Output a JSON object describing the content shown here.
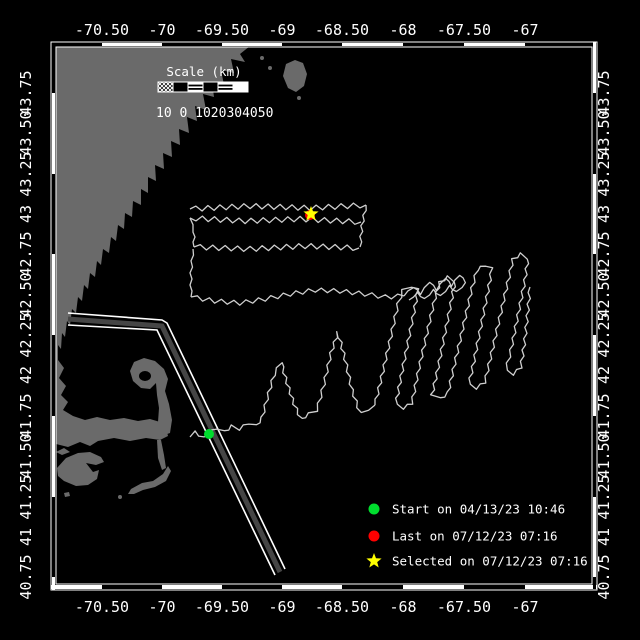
{
  "colors": {
    "background": "#000000",
    "frame": "#ffffff",
    "text": "#ffffff",
    "land": "#6a6a6a",
    "track": "#cfcfcf",
    "lane_center": "#454545",
    "lane_edge": "#ffffff",
    "green": "#00dd2e",
    "red": "#ff0000",
    "yellow": "#ffff00"
  },
  "map_frame": {
    "outer": [
      51,
      42,
      597,
      590
    ],
    "inner": [
      56,
      47,
      592,
      584
    ],
    "x_ticks": [
      51,
      102,
      162,
      222,
      282,
      342,
      403,
      464,
      525,
      597
    ],
    "y_ticks": [
      42,
      93,
      174,
      254,
      335,
      416,
      497,
      577,
      590
    ]
  },
  "axes": {
    "x_labels": [
      "-70.50",
      "-70",
      "-69.50",
      "-69",
      "-68.50",
      "-68",
      "-67.50",
      "-67"
    ],
    "x_positions": [
      102,
      162,
      222,
      282,
      342,
      403,
      464,
      525
    ],
    "top_baseline_y": 35,
    "bottom_baseline_y": 612,
    "y_labels": [
      "40.75",
      "41",
      "41.25",
      "41.50",
      "41.75",
      "42",
      "42.25",
      "42.50",
      "42.75",
      "43",
      "43.25",
      "43.50",
      "43.75"
    ],
    "y_positions": [
      577,
      537,
      497,
      456,
      416,
      375,
      335,
      295,
      254,
      214,
      174,
      133,
      93
    ],
    "left_center_x": 31,
    "right_center_x": 609
  },
  "scale_bar": {
    "title": "Scale (km)",
    "title_x": 204,
    "title_y": 76,
    "bar_x": 158,
    "bar_y": 82,
    "cell_w": 15,
    "cell_h": 10,
    "cells": [
      "hatch",
      "black",
      "striped",
      "black",
      "striped",
      "white"
    ],
    "labels_text": "10 0 1020304050",
    "labels_x": 156,
    "labels_y": 117
  },
  "legend": {
    "marker_x": 374,
    "text_x": 392,
    "rows_y": [
      509,
      536,
      561
    ],
    "items": [
      {
        "marker": "green-dot",
        "label": "Start on 04/13/23 10:46"
      },
      {
        "marker": "red-dot",
        "label": "Last on 07/12/23 07:16"
      },
      {
        "marker": "yellow-star",
        "label": "Selected on 07/12/23 07:16"
      }
    ]
  },
  "markers": {
    "start": {
      "x": 209,
      "y": 434,
      "type": "circle",
      "r": 5,
      "color": "#00dd2e"
    },
    "last": {
      "x": 310,
      "y": 215,
      "type": "circle",
      "r": 5,
      "color": "#ff0000"
    },
    "selected": {
      "x": 311,
      "y": 214,
      "type": "star",
      "r": 8,
      "color": "#ffff00"
    }
  },
  "land": {
    "polygons": [
      [
        [
          56,
          46
        ],
        [
          250,
          46
        ],
        [
          240,
          54
        ],
        [
          245,
          62
        ],
        [
          231,
          59
        ],
        [
          234,
          73
        ],
        [
          221,
          70
        ],
        [
          224,
          85
        ],
        [
          212,
          82
        ],
        [
          214,
          97
        ],
        [
          203,
          94
        ],
        [
          206,
          110
        ],
        [
          195,
          106
        ],
        [
          197,
          121
        ],
        [
          187,
          117
        ],
        [
          189,
          133
        ],
        [
          179,
          129
        ],
        [
          180,
          145
        ],
        [
          171,
          141
        ],
        [
          172,
          157
        ],
        [
          163,
          153
        ],
        [
          164,
          169
        ],
        [
          155,
          165
        ],
        [
          156,
          181
        ],
        [
          148,
          177
        ],
        [
          148,
          193
        ],
        [
          141,
          189
        ],
        [
          141,
          205
        ],
        [
          133,
          201
        ],
        [
          132,
          217
        ],
        [
          125,
          213
        ],
        [
          124,
          229
        ],
        [
          118,
          225
        ],
        [
          116,
          241
        ],
        [
          111,
          237
        ],
        [
          109,
          253
        ],
        [
          103,
          249
        ],
        [
          101,
          265
        ],
        [
          97,
          261
        ],
        [
          95,
          277
        ],
        [
          90,
          273
        ],
        [
          88,
          289
        ],
        [
          84,
          285
        ],
        [
          82,
          301
        ],
        [
          78,
          297
        ],
        [
          76,
          313
        ],
        [
          72,
          309
        ],
        [
          70,
          325
        ],
        [
          67,
          321
        ],
        [
          65,
          337
        ],
        [
          62,
          333
        ],
        [
          61,
          349
        ],
        [
          58,
          345
        ],
        [
          58,
          360
        ],
        [
          64,
          368
        ],
        [
          59,
          378
        ],
        [
          66,
          386
        ],
        [
          61,
          395
        ],
        [
          68,
          402
        ],
        [
          63,
          410
        ],
        [
          73,
          416
        ],
        [
          85,
          420
        ],
        [
          97,
          417
        ],
        [
          110,
          420
        ],
        [
          124,
          418
        ],
        [
          138,
          421
        ],
        [
          150,
          419
        ],
        [
          160,
          422
        ],
        [
          166,
          428
        ],
        [
          168,
          436
        ],
        [
          160,
          440
        ],
        [
          146,
          438
        ],
        [
          130,
          441
        ],
        [
          114,
          438
        ],
        [
          98,
          441
        ],
        [
          90,
          446
        ],
        [
          80,
          442
        ],
        [
          68,
          447
        ],
        [
          56,
          444
        ]
      ],
      [
        [
          156,
          438
        ],
        [
          170,
          433
        ],
        [
          172,
          420
        ],
        [
          169,
          404
        ],
        [
          165,
          391
        ],
        [
          168,
          379
        ],
        [
          164,
          369
        ],
        [
          155,
          361
        ],
        [
          144,
          358
        ],
        [
          134,
          362
        ],
        [
          130,
          371
        ],
        [
          133,
          381
        ],
        [
          141,
          388
        ],
        [
          150,
          389
        ],
        [
          156,
          383
        ],
        [
          157,
          395
        ],
        [
          159,
          408
        ],
        [
          158,
          422
        ]
      ],
      [
        [
          157,
          440
        ],
        [
          161,
          440
        ],
        [
          164,
          455
        ],
        [
          166,
          468
        ],
        [
          162,
          470
        ],
        [
          158,
          458
        ]
      ],
      [
        [
          131,
          489
        ],
        [
          142,
          483
        ],
        [
          153,
          481
        ],
        [
          163,
          474
        ],
        [
          168,
          466
        ],
        [
          171,
          471
        ],
        [
          166,
          481
        ],
        [
          155,
          487
        ],
        [
          143,
          490
        ],
        [
          134,
          494
        ],
        [
          128,
          494
        ]
      ],
      [
        [
          57,
          468
        ],
        [
          66,
          458
        ],
        [
          78,
          453
        ],
        [
          90,
          452
        ],
        [
          101,
          457
        ],
        [
          104,
          462
        ],
        [
          96,
          465
        ],
        [
          86,
          463
        ],
        [
          93,
          472
        ],
        [
          99,
          470
        ],
        [
          97,
          479
        ],
        [
          88,
          485
        ],
        [
          76,
          486
        ],
        [
          64,
          481
        ],
        [
          58,
          476
        ]
      ],
      [
        [
          56,
          452
        ],
        [
          64,
          448
        ],
        [
          70,
          452
        ],
        [
          62,
          455
        ]
      ],
      [
        [
          64,
          493
        ],
        [
          69,
          492
        ],
        [
          70,
          496
        ],
        [
          65,
          497
        ]
      ],
      [
        [
          286,
          64
        ],
        [
          295,
          60
        ],
        [
          303,
          63
        ],
        [
          307,
          74
        ],
        [
          304,
          86
        ],
        [
          296,
          92
        ],
        [
          288,
          88
        ],
        [
          283,
          76
        ]
      ]
    ],
    "harbor_cut": {
      "cx": 145,
      "cy": 376,
      "rx": 6,
      "ry": 5
    },
    "spots": [
      [
        262,
        58,
        2
      ],
      [
        270,
        68,
        2
      ],
      [
        299,
        98,
        2
      ],
      [
        220,
        58,
        2
      ],
      [
        206,
        76,
        2
      ],
      [
        186,
        90,
        2
      ],
      [
        168,
        112,
        2
      ],
      [
        150,
        130,
        2
      ],
      [
        120,
        497,
        2
      ]
    ]
  },
  "lane": {
    "edges": [
      [
        [
          68,
          313
        ],
        [
          162,
          320
        ],
        [
          167,
          323
        ],
        [
          285,
          569
        ]
      ],
      [
        [
          68,
          325
        ],
        [
          157,
          330
        ],
        [
          275,
          575
        ]
      ]
    ],
    "center": [
      [
        68,
        319
      ],
      [
        162,
        326
      ],
      [
        280,
        572
      ]
    ]
  },
  "track": {
    "paths": [
      {
        "pts": [
          [
            190,
            209
          ],
          [
            250,
            206
          ],
          [
            310,
            208
          ],
          [
            366,
            205
          ]
        ],
        "amp": 2.6
      },
      {
        "pts": [
          [
            366,
            205
          ],
          [
            362,
            226
          ],
          [
            360,
            247
          ]
        ],
        "amp": 1.2
      },
      {
        "pts": [
          [
            361,
            222
          ],
          [
            300,
            219
          ],
          [
            245,
            221
          ],
          [
            190,
            218
          ]
        ],
        "amp": 2.6
      },
      {
        "pts": [
          [
            190,
            218
          ],
          [
            194,
            232
          ],
          [
            194,
            247
          ]
        ],
        "amp": 1.0
      },
      {
        "pts": [
          [
            194,
            247
          ],
          [
            250,
            249
          ],
          [
            305,
            246
          ],
          [
            359,
            248
          ]
        ],
        "amp": 2.6
      },
      {
        "pts": [
          [
            193,
            249
          ],
          [
            191,
            273
          ],
          [
            191,
            297
          ]
        ],
        "amp": 1.0
      },
      {
        "pts": [
          [
            191,
            297
          ],
          [
            215,
            301
          ],
          [
            240,
            303
          ],
          [
            265,
            299
          ],
          [
            290,
            294
          ],
          [
            315,
            290
          ],
          [
            340,
            291
          ],
          [
            365,
            294
          ],
          [
            385,
            297
          ],
          [
            404,
            296
          ]
        ],
        "amp": 2.2
      },
      {
        "pts": [
          [
            404,
            296
          ],
          [
            413,
            287
          ],
          [
            421,
            294
          ],
          [
            429,
            282
          ],
          [
            437,
            290
          ],
          [
            445,
            278
          ],
          [
            452,
            286
          ],
          [
            459,
            275
          ],
          [
            466,
            282
          ],
          [
            457,
            292
          ],
          [
            449,
            286
          ],
          [
            441,
            296
          ],
          [
            433,
            290
          ],
          [
            425,
            299
          ],
          [
            417,
            293
          ],
          [
            409,
            300
          ]
        ],
        "amp": 0.8
      },
      {
        "pts": [
          [
            190,
            437
          ],
          [
            196,
            432
          ],
          [
            203,
            438
          ],
          [
            209,
            434
          ],
          [
            216,
            428
          ],
          [
            224,
            432
          ],
          [
            232,
            426
          ],
          [
            240,
            429
          ],
          [
            248,
            423
          ],
          [
            256,
            426
          ],
          [
            262,
            418
          ],
          [
            267,
            399
          ],
          [
            274,
            375
          ],
          [
            281,
            362
          ],
          [
            287,
            383
          ],
          [
            294,
            404
          ],
          [
            301,
            419
          ],
          [
            309,
            414
          ],
          [
            317,
            410
          ],
          [
            324,
            384
          ],
          [
            331,
            353
          ],
          [
            338,
            332
          ],
          [
            345,
            359
          ],
          [
            352,
            390
          ],
          [
            360,
            413
          ],
          [
            368,
            409
          ],
          [
            375,
            405
          ]
        ],
        "amp": 1.4
      },
      {
        "pts": [
          [
            375,
            405
          ],
          [
            383,
            371
          ],
          [
            391,
            336
          ],
          [
            398,
            304
          ],
          [
            403,
            290
          ],
          [
            411,
            286
          ],
          [
            418,
            290
          ],
          [
            414,
            312
          ],
          [
            407,
            347
          ],
          [
            400,
            382
          ],
          [
            396,
            404
          ],
          [
            404,
            408
          ],
          [
            412,
            403
          ],
          [
            419,
            368
          ],
          [
            427,
            333
          ],
          [
            435,
            298
          ],
          [
            440,
            282
          ],
          [
            448,
            277
          ],
          [
            455,
            281
          ],
          [
            451,
            303
          ],
          [
            444,
            338
          ],
          [
            437,
            373
          ],
          [
            432,
            395
          ],
          [
            440,
            399
          ],
          [
            448,
            393
          ],
          [
            456,
            358
          ],
          [
            464,
            323
          ],
          [
            472,
            288
          ],
          [
            477,
            270
          ],
          [
            485,
            265
          ],
          [
            492,
            269
          ],
          [
            488,
            291
          ],
          [
            481,
            326
          ],
          [
            474,
            361
          ],
          [
            469,
            384
          ],
          [
            477,
            388
          ],
          [
            485,
            382
          ],
          [
            493,
            347
          ],
          [
            501,
            312
          ],
          [
            509,
            277
          ],
          [
            513,
            259
          ],
          [
            521,
            254
          ],
          [
            528,
            258
          ],
          [
            525,
            280
          ],
          [
            518,
            315
          ],
          [
            511,
            350
          ],
          [
            506,
            370
          ],
          [
            514,
            374
          ],
          [
            521,
            367
          ],
          [
            525,
            339
          ],
          [
            528,
            310
          ],
          [
            530,
            287
          ]
        ],
        "amp": 1.4
      }
    ]
  }
}
